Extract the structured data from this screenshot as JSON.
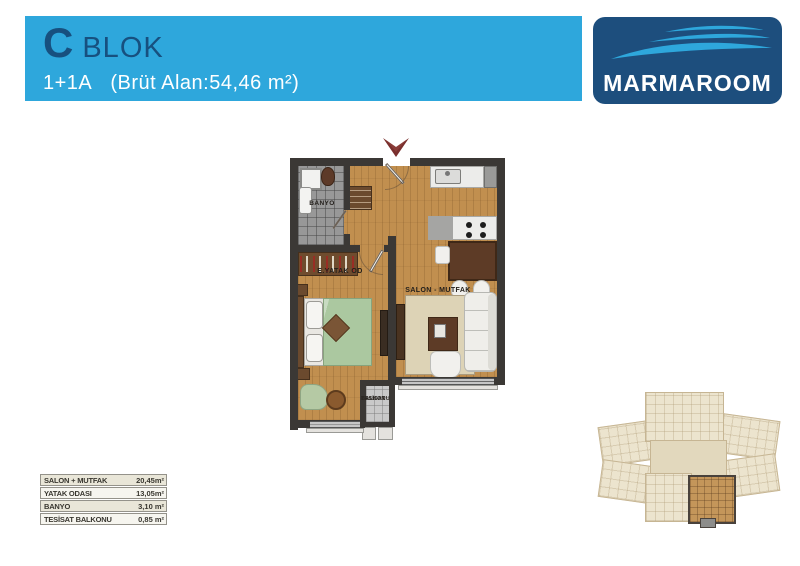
{
  "header": {
    "block_letter": "C",
    "block_word": "BLOK",
    "unit_code": "1+1A",
    "gross_area": "(Brüt Alan:54,46 m²)",
    "bg_color": "#2ea7dc",
    "text_color": "#17507f"
  },
  "logo": {
    "text": "MARMAROOM",
    "bg_color": "#1d4e7d",
    "swoosh_color": "#2ea7dc"
  },
  "floor_plan": {
    "entry_arrow_icon": "chevron-down",
    "labels": {
      "bathroom": "BANYO",
      "bedroom": "E.YATAK OD",
      "living_kitchen": "SALON - MUTFAK",
      "balcony_line1": "TESİSAT",
      "balcony_line2": "BALKONU"
    },
    "colors": {
      "wall": "#3b3835",
      "wood_floor": "#c18f4f",
      "tile_floor": "#989898",
      "balcony_floor": "#c9c9c9",
      "bed_green": "#abc8a0",
      "arrow_red": "#7a2f2d"
    }
  },
  "area_table": {
    "rows": [
      {
        "label": "SALON + MUTFAK",
        "value": "20,45m²"
      },
      {
        "label": "YATAK ODASI",
        "value": "13,05m²"
      },
      {
        "label": "BANYO",
        "value": "3,10 m²"
      },
      {
        "label": "TESİSAT BALKONU",
        "value": "0,85 m²"
      }
    ]
  }
}
